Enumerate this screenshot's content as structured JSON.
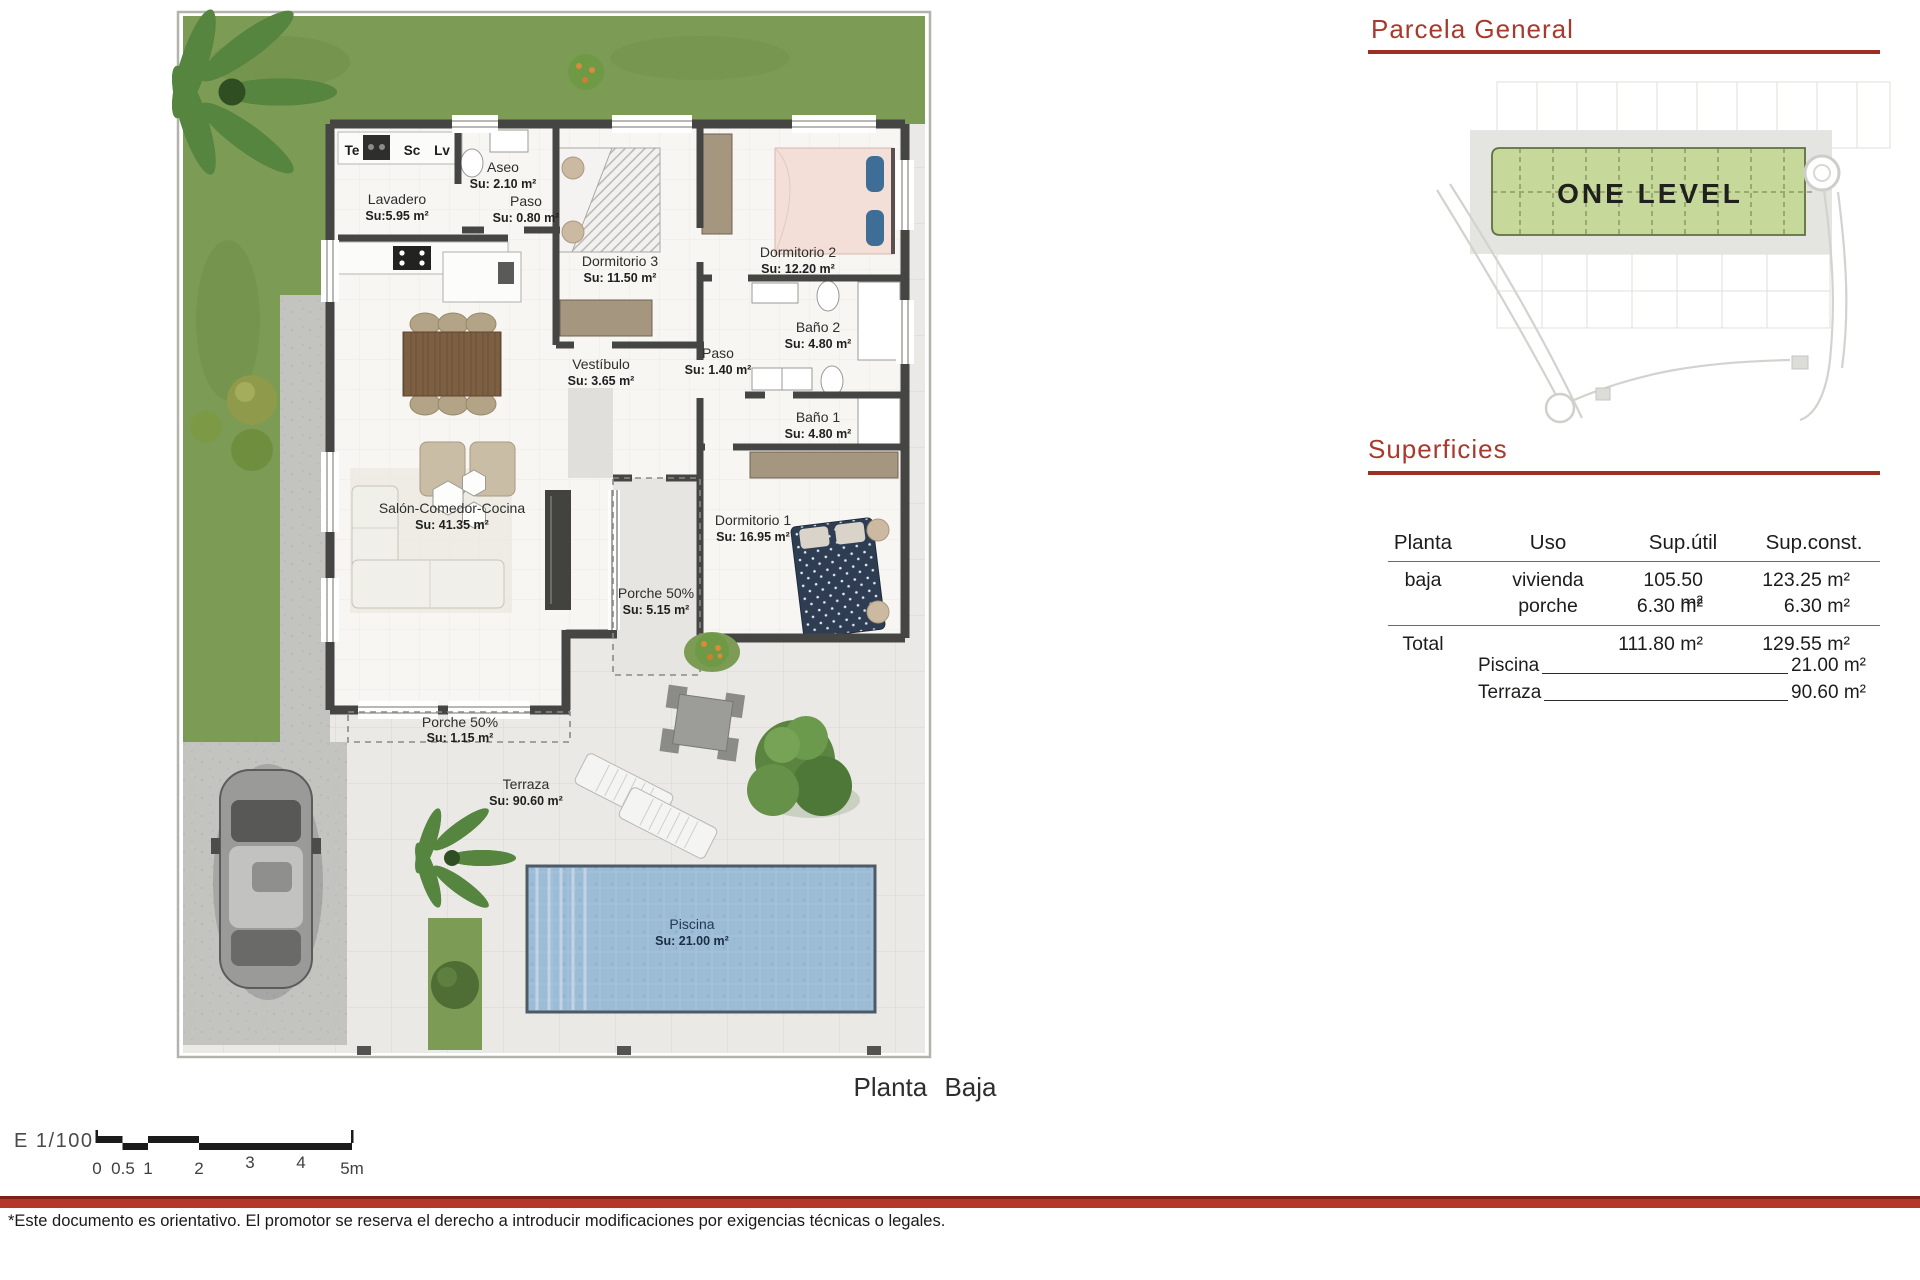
{
  "parcela": {
    "title": "Parcela  General",
    "site_label": "ONE LEVEL"
  },
  "superficies": {
    "title": "Superficies",
    "columns": [
      "Planta",
      "Uso",
      "Sup.útil",
      "Sup.const."
    ],
    "rows": [
      {
        "planta": "baja",
        "uso": "vivienda",
        "util": "105.50  m²",
        "const": "123.25  m²"
      },
      {
        "planta": "",
        "uso": "porche",
        "util": "6.30  m²",
        "const": "6.30  m²"
      }
    ],
    "total": {
      "label": "Total",
      "util": "111.80  m²",
      "const": "129.55  m²"
    },
    "extras": [
      {
        "label": "Piscina",
        "value": "21.00  m²"
      },
      {
        "label": "Terraza",
        "value": "90.60  m²"
      }
    ]
  },
  "floorplan": {
    "caption": "Planta  Baja",
    "kitchen_labels": [
      "Te",
      "Sc",
      "Lv"
    ],
    "rooms": [
      {
        "name": "Lavadero",
        "area": "Su:5.95 m²"
      },
      {
        "name": "Aseo",
        "area": "Su: 2.10 m²"
      },
      {
        "name": "Paso",
        "area": "Su: 0.80 m²"
      },
      {
        "name": "Dormitorio 3",
        "area": "Su: 11.50 m²"
      },
      {
        "name": "Dormitorio 2",
        "area": "Su: 12.20 m²"
      },
      {
        "name": "Baño 2",
        "area": "Su: 4.80 m²"
      },
      {
        "name": "Paso",
        "area": "Su: 1.40 m²"
      },
      {
        "name": "Vestíbulo",
        "area": "Su: 3.65 m²"
      },
      {
        "name": "Baño 1",
        "area": "Su: 4.80 m²"
      },
      {
        "name": "Dormitorio 1",
        "area": "Su: 16.95 m²"
      },
      {
        "name": "Salón-Comedor-Cocina",
        "area": "Su: 41.35 m²"
      },
      {
        "name": "Porche 50%",
        "area": "Su: 5.15 m²"
      },
      {
        "name": "Porche 50%",
        "area": "Su: 1.15 m²"
      },
      {
        "name": "Terraza",
        "area": "Su: 90.60 m²"
      },
      {
        "name": "Piscina",
        "area": "Su: 21.00 m²"
      }
    ]
  },
  "scalebar": {
    "scale_label": "E  1/100",
    "ticks": [
      "0",
      "0.5",
      "1",
      "2",
      "3",
      "4",
      "5m"
    ]
  },
  "footer": {
    "disclaimer": "*Este documento es orientativo. El promotor se reserva el derecho a introducir modificaciones por exigencias técnicas o legales."
  },
  "colors": {
    "accent_red": "#a8392c",
    "rule_red": "#9e2f23",
    "footer_band": "#b5362b",
    "grass_green": "#7c9b54",
    "site_plan_green": "#c6d99b",
    "pool_blue": "#9cbcd6",
    "wall_dark": "#454543"
  }
}
